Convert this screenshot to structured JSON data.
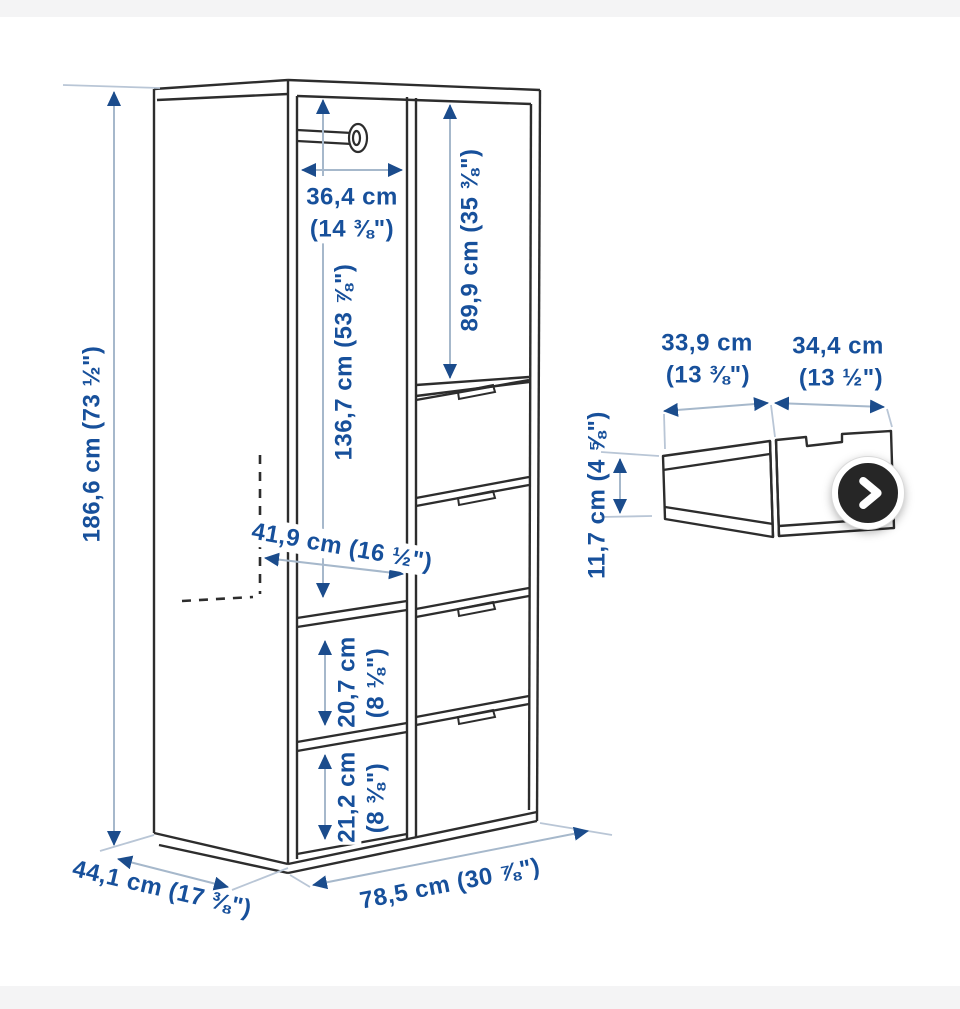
{
  "colors": {
    "label_blue": "#17509b",
    "dimension_line": "#a6b8cb",
    "arrow_head": "#1b4c8c",
    "furniture_line": "#2d2d2d",
    "page_band": "#f4f4f5",
    "next_button_bg": "#262626",
    "next_button_ring": "#ffffff"
  },
  "wardrobe": {
    "height_label": "186,6 cm (73 ½\")",
    "rail_width_label_cm": "36,4 cm",
    "rail_width_label_in": "(14 ⅜\")",
    "left_column_height_label": "136,7 cm (53 ⅞\")",
    "right_top_height_label": "89,9 cm (35 ⅜\")",
    "interior_width_label": "41,9 cm (16 ½\")",
    "shelf_upper_label_cm": "20,7 cm",
    "shelf_upper_label_in": "(8 ⅛\")",
    "shelf_lower_label_cm": "21,2 cm",
    "shelf_lower_label_in": "(8 ⅜\")",
    "depth_label": "44,1 cm (17 ⅜\")",
    "width_label": "78,5 cm (30 ⅞\")"
  },
  "drawer": {
    "back_width_label_cm": "33,9 cm",
    "back_width_label_in": "(13 ⅜\")",
    "front_width_label_cm": "34,4 cm",
    "front_width_label_in": "(13 ½\")",
    "height_label": "11,7 cm (4 ⅝\")"
  },
  "controls": {
    "next_aria": "Next image"
  },
  "icons": {
    "next_button": "chevron-right"
  }
}
